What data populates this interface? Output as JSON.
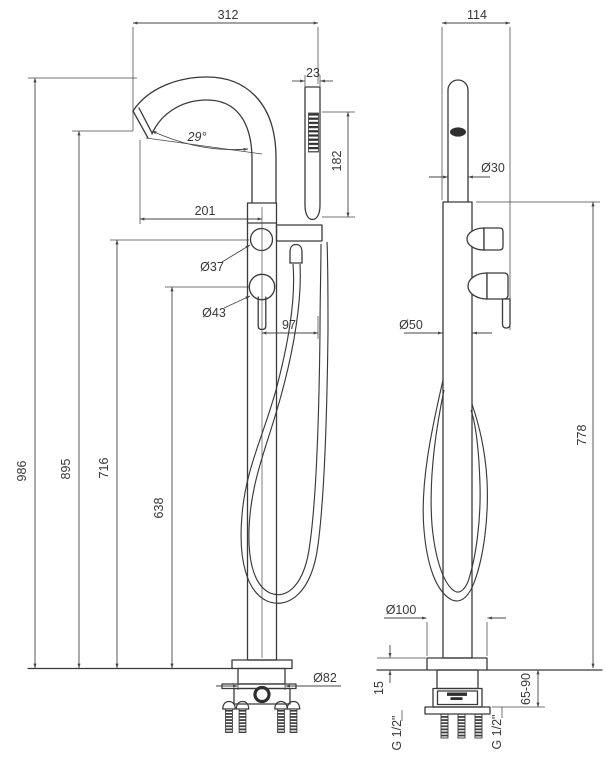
{
  "drawing": {
    "type": "technical-dimension-drawing",
    "subject": "freestanding floor-mounted bath mixer with hand shower",
    "units": "mm"
  },
  "views": {
    "front": {
      "name": "front view",
      "dims": {
        "overall_width": "312",
        "handshower_width": "23",
        "handshower_length": "182",
        "spout_angle": "29°",
        "spout_reach": "201",
        "diverter_diameter": "Ø37",
        "handle_diameter": "Ø43",
        "handshower_offset": "97",
        "height_overall": "986",
        "height_spout_outlet": "895",
        "height_diverter": "716",
        "height_handle": "638",
        "base_cover_diameter": "Ø82"
      }
    },
    "side": {
      "name": "side view",
      "dims": {
        "depth": "114",
        "spout_tube_diameter": "Ø30",
        "column_diameter": "Ø50",
        "body_height": "778",
        "base_plate_diameter": "Ø100",
        "base_cover_height": "15",
        "floor_clearance": "65-90",
        "inlet_connection_left": "G 1/2\"",
        "inlet_connection_right": "G 1/2\""
      }
    }
  }
}
